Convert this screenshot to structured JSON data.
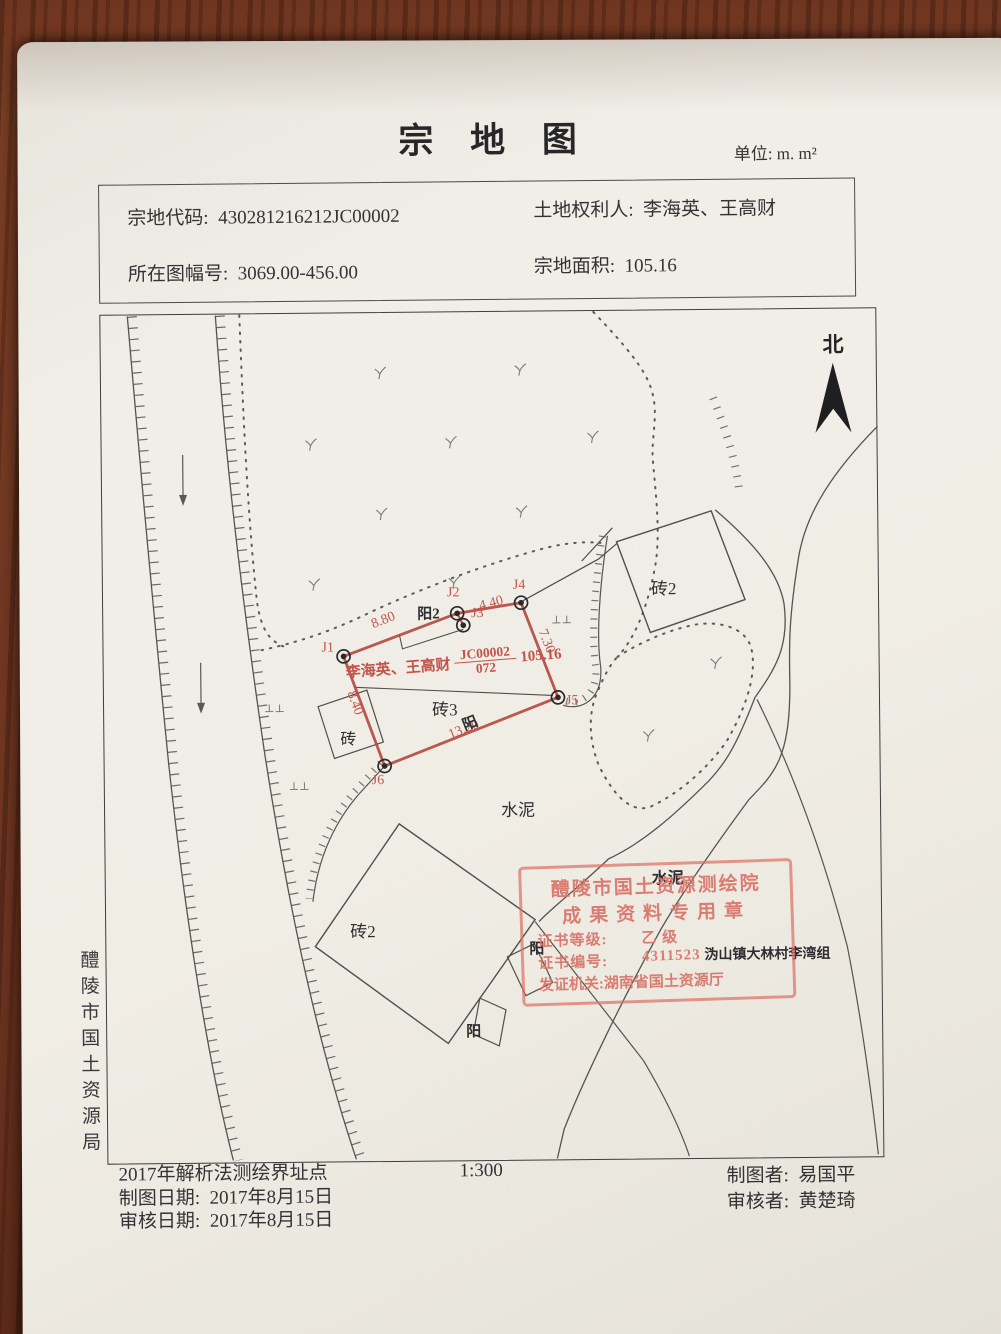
{
  "title": "宗 地 图",
  "unit": "单位: m. m²",
  "info": {
    "parcel_code_label": "宗地代码:",
    "parcel_code": "430281216212JC00002",
    "rights_holder_label": "土地权利人:",
    "rights_holder": "李海英、王高财",
    "map_sheet_label": "所在图幅号:",
    "map_sheet": "3069.00-456.00",
    "area_label": "宗地面积:",
    "area": "105.16"
  },
  "north": "北",
  "agency_vertical": "醴陵市国土资源局",
  "map": {
    "points": [
      "J1",
      "J2",
      "J3",
      "J4",
      "J5",
      "J6"
    ],
    "measurements": [
      "8.80",
      "4.40",
      "7.30",
      "8.40",
      "13.20"
    ],
    "owner": {
      "name": "李海英、王高财",
      "num": "JC00002",
      "den": "072",
      "area": "105.16"
    },
    "labels": [
      "砖2",
      "砖2",
      "砖3",
      "砖",
      "阳2",
      "阳",
      "阳",
      "阳",
      "水泥",
      "水泥",
      "⊥⊥",
      "⊥⊥",
      "⊥⊥",
      "沩山镇大林村李湾组"
    ]
  },
  "stamp": {
    "line1": "醴陵市国土资源测绘院",
    "line2": "成果资料专用章",
    "grade_label": "证书等级:",
    "grade": "乙 级",
    "number_label": "证书编号:",
    "number": "4311523",
    "issuer": "发证机关:湖南省国土资源厅"
  },
  "footer": {
    "method_note": "2017年解析法测绘界址点",
    "draw_date_label": "制图日期:",
    "draw_date": "2017年8月15日",
    "review_date_label": "审核日期:",
    "review_date": "2017年8月15日",
    "scale": "1:300",
    "drafter_label": "制图者:",
    "drafter": "易国平",
    "reviewer_label": "审核者:",
    "reviewer": "黄楚琦"
  },
  "colors": {
    "parcel_red": "#b5463e",
    "stamp_red": "#dd6c62",
    "ink": "#3a3a3c",
    "paper": "#efece5",
    "wood": "#713722"
  }
}
